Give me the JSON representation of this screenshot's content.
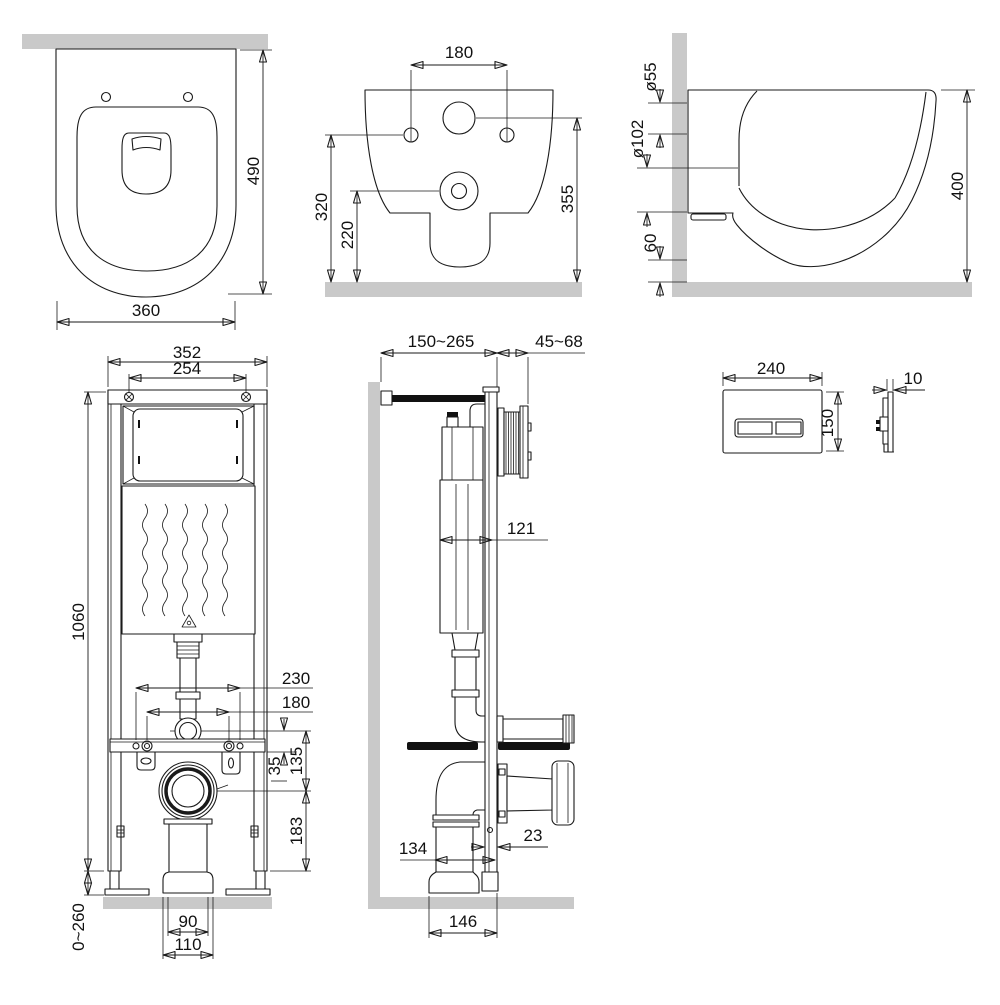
{
  "drawing": {
    "background": "#ffffff",
    "line_color": "#1a1a1a",
    "wall_fill": "#c9c9c9"
  },
  "views": {
    "toilet_top": {
      "dim_depth": "490",
      "dim_width": "360"
    },
    "toilet_rear": {
      "dim_bolt_spacing": "180",
      "dim_bolt_height": "320",
      "dim_outlet_height": "220",
      "dim_inlet_height": "355"
    },
    "toilet_side": {
      "dim_inlet_diameter": "ø55",
      "dim_outlet_diameter": "ø102",
      "dim_bottom_clearance": "60",
      "dim_height": "400"
    },
    "frame_front": {
      "dim_outer_width": "352",
      "dim_inner_width": "254",
      "dim_height": "1060",
      "dim_outer_bolt_spacing": "230",
      "dim_inner_bolt_spacing": "180",
      "dim_flush_to_bar": "35",
      "dim_flush_to_outlet": "135",
      "dim_outlet_to_base": "183",
      "dim_feet_range": "0~260",
      "dim_drain_pipe_width": "90",
      "dim_drain_socket_width": "110"
    },
    "frame_side": {
      "dim_wall_distance": "150~265",
      "dim_plate_depth": "45~68",
      "dim_cistern_depth": "121",
      "dim_rail_depth": "23",
      "dim_drain_offset": "134",
      "dim_base_depth": "146"
    },
    "flush_plate": {
      "dim_width": "240",
      "dim_height": "150",
      "dim_thickness": "10"
    }
  }
}
